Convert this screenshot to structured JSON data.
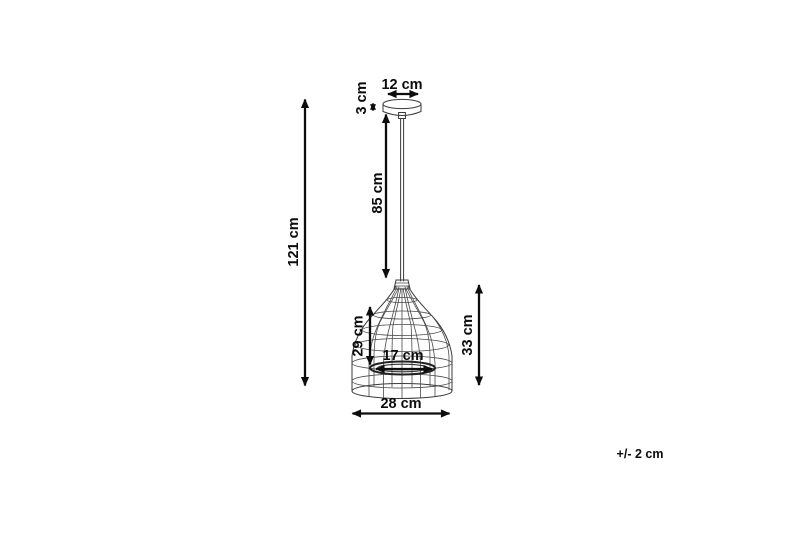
{
  "drawing": {
    "subject": "cage-pendant-lamp-dimension-diagram",
    "background_color": "#ffffff",
    "line_color": "#3a3a3a",
    "dimension_color": "#0d0d0d"
  },
  "dimensions": {
    "total_height": "121 cm",
    "canopy_diameter": "12 cm",
    "canopy_height": "3 cm",
    "cord_length": "85 cm",
    "shade_inner_height": "29 cm",
    "inner_ring_diameter": "17 cm",
    "shade_height": "33 cm",
    "shade_diameter": "28 cm",
    "tolerance": "+/- 2 cm"
  }
}
